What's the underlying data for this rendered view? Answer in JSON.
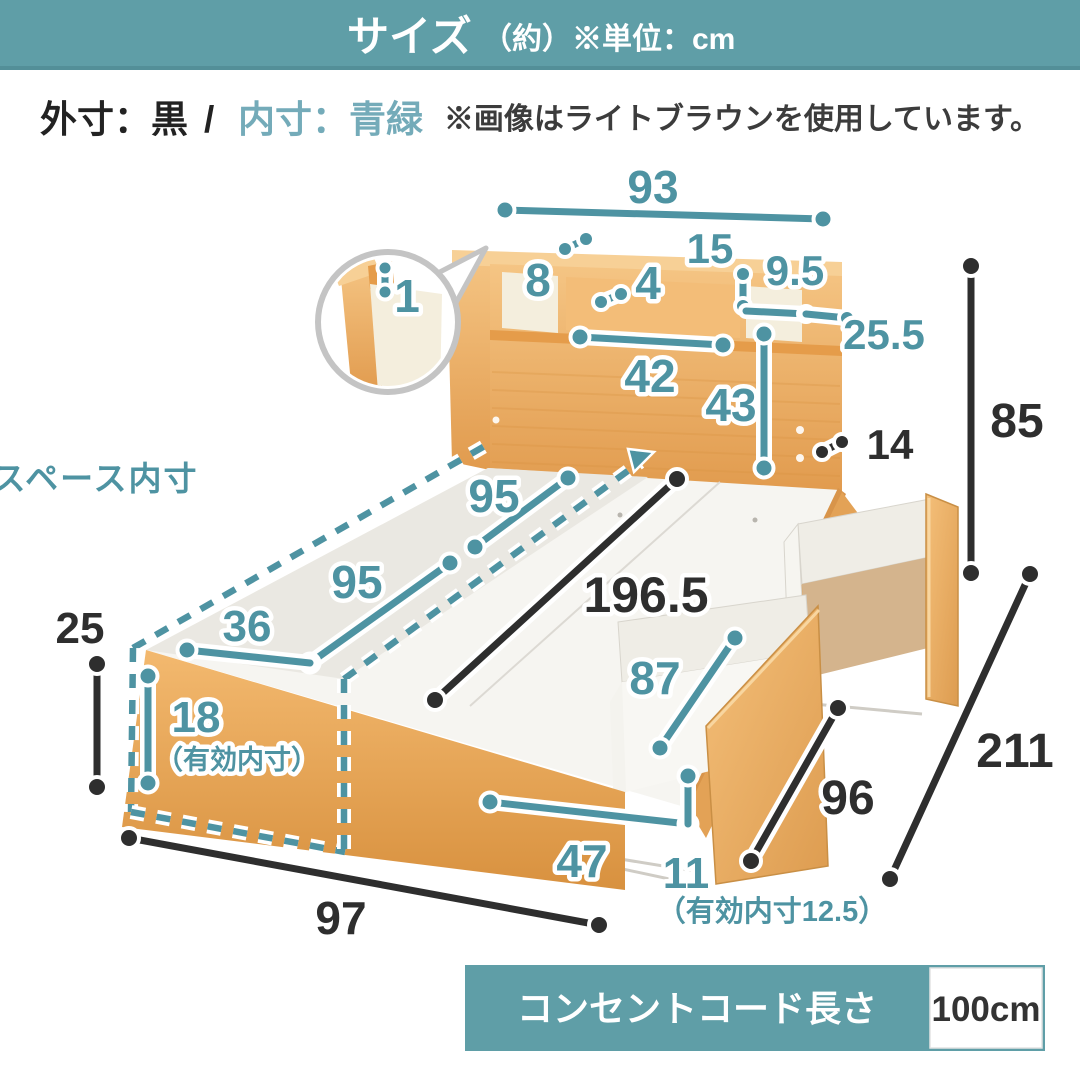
{
  "banner": {
    "title": "サイズ",
    "unit_note": "（約）※単位：cm"
  },
  "legend": {
    "outer_label": "外寸：黒",
    "separator": "/",
    "inner_label": "内寸：青緑",
    "image_note": "※画像はライトブラウンを使用しています。"
  },
  "diagram": {
    "space_label": "床板下スペース内寸",
    "labels": {
      "w93": "93",
      "w8": "8",
      "w4": "4",
      "h15": "15",
      "w9_5": "9.5",
      "w25_5": "25.5",
      "w42": "42",
      "h43": "43",
      "t1": "1",
      "w95a": "95",
      "w95b": "95",
      "w36": "36",
      "h18": "18",
      "h18_note": "（有効内寸）",
      "l87": "87",
      "w47": "47",
      "h11": "11",
      "h11_note": "（有効内寸12.5）",
      "b14": "14",
      "b85": "85",
      "b196_5": "196.5",
      "b25": "25",
      "b97": "97",
      "b96": "96",
      "b211": "211"
    }
  },
  "spec_box": {
    "label": "コンセントコード長さ",
    "value": "100cm"
  },
  "colors": {
    "accent_teal": "#4e93a2",
    "legend_teal": "#74abb9",
    "banner_teal": "#5f9ea7",
    "dimension_black": "#2e2e2e",
    "wood_mid": "#edab5e"
  }
}
